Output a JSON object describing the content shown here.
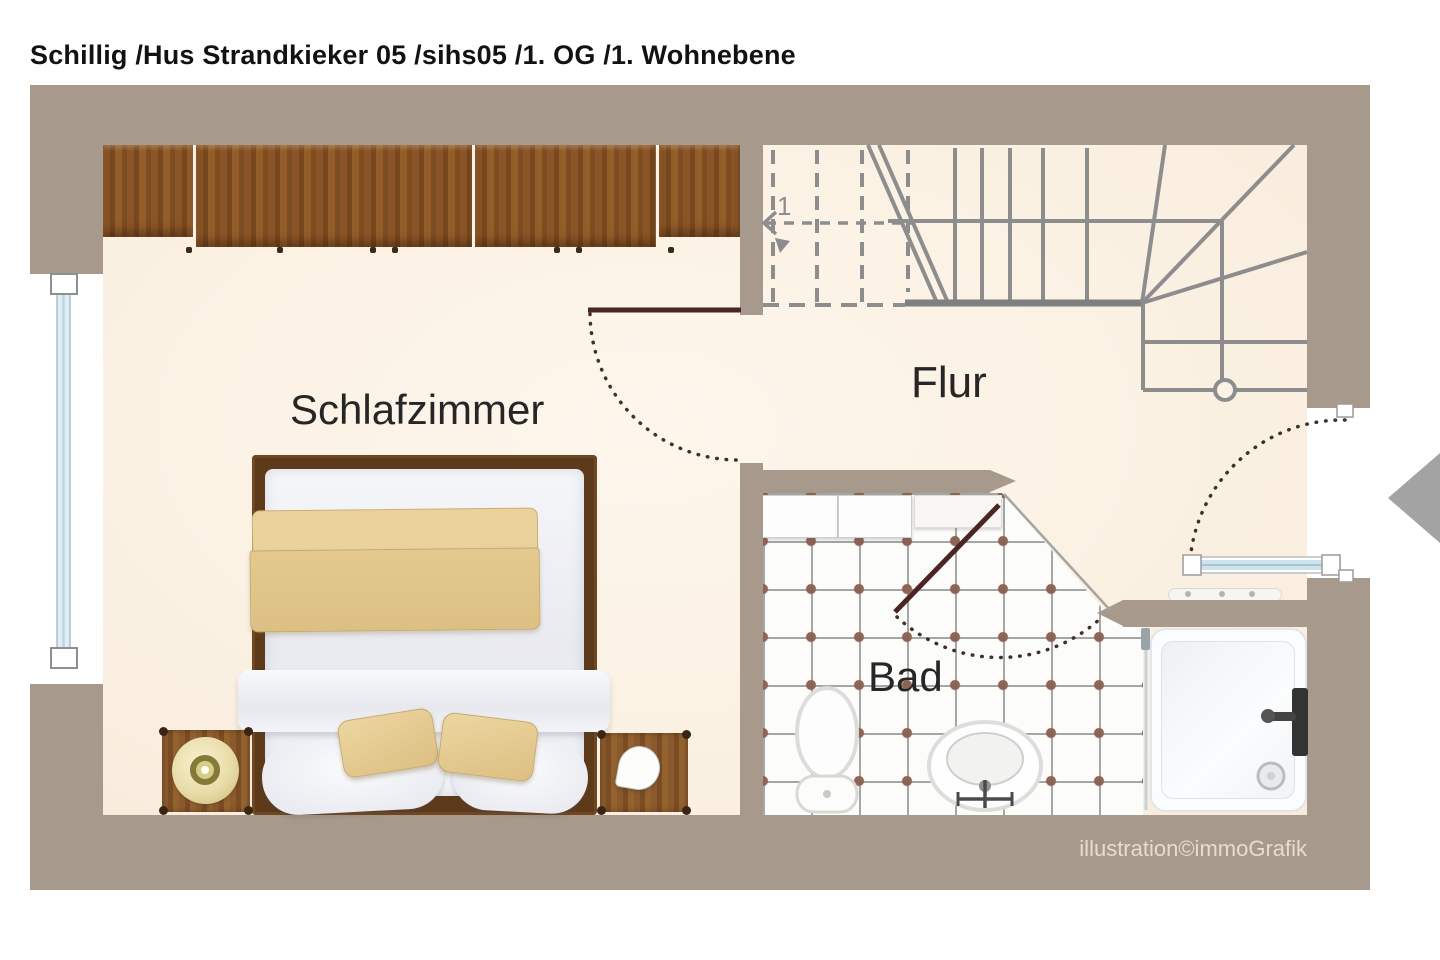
{
  "title": "Schillig /Hus Strandkieker 05 /sihs05 /1. OG /1. Wohnebene",
  "rooms": {
    "bedroom": {
      "label": "Schlafzimmer"
    },
    "hallway": {
      "label": "Flur"
    },
    "bathroom": {
      "label": "Bad"
    }
  },
  "stairs": {
    "step_number": "1"
  },
  "credit": "illustration©immoGrafik",
  "icons": {
    "nav_prev": "left-triangle-arrow",
    "door_swing": "dotted-arc",
    "newel_post": "circle"
  },
  "colors": {
    "wall": "#a79a8c",
    "floor": "#fbf1e3",
    "wood": "#82512a",
    "door_leaf": "#4b2522",
    "glass": "#cfe3ed",
    "tile_dot": "#8d6353",
    "stair_line": "#8d8d8d"
  }
}
